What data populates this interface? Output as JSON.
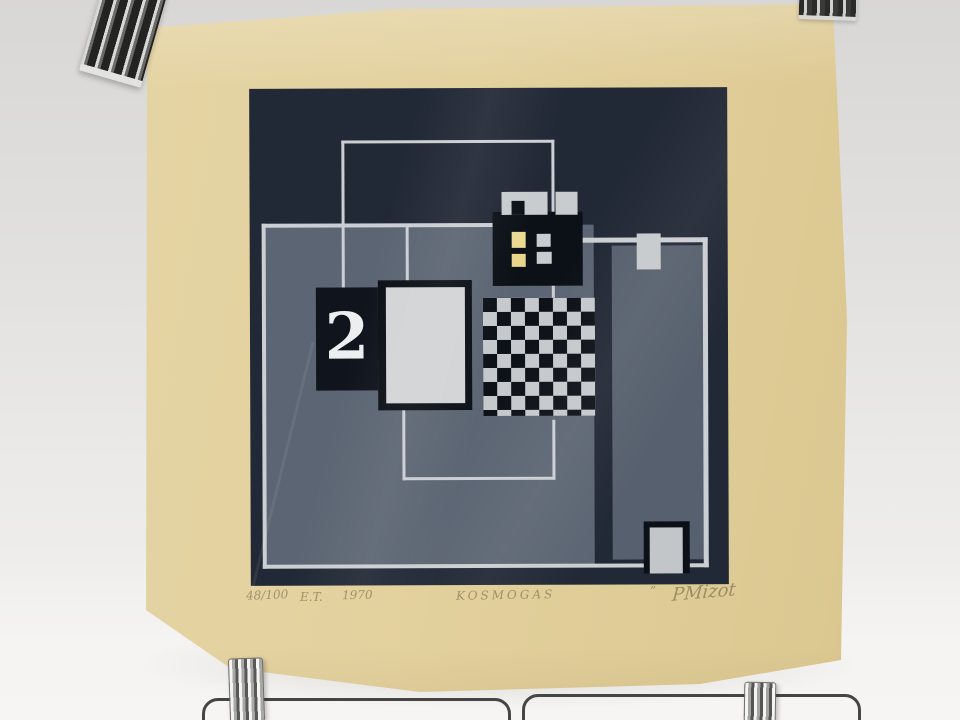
{
  "artwork": {
    "numeral": "2",
    "inscriptions": {
      "edition": "48/100",
      "proof_mark": "E.T.",
      "year": "1970",
      "title": "KOSMOGAS",
      "stray_mark": "”",
      "signature": "PMizot"
    },
    "palette": {
      "paper_cream": "#e3d19e",
      "print_dark_navy": "#222936",
      "panel_gray": "#5c6573",
      "silver": "#cbced3",
      "accent_yellow": "#ecd992",
      "checker_black": "#0d1118",
      "backdrop_gray": "#e1e0de"
    }
  }
}
